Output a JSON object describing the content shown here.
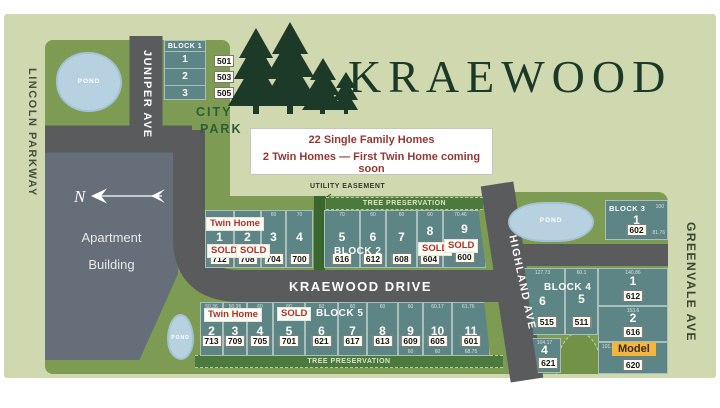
{
  "title": "KRAEWOOD",
  "info_box": {
    "line1": "22 Single Family Homes",
    "line2": "2 Twin Homes — First Twin Home coming soon"
  },
  "streets": {
    "lincoln_parkway": "LINCOLN PARKWAY",
    "juniper_ave": "JUNIPER AVE",
    "kraewood_drive": "KRAEWOOD DRIVE",
    "highland_ave": "HIGHLAND AVE",
    "greenvale_ave": "GREENVALE AVE"
  },
  "areas": {
    "city_park_line1": "CITY",
    "city_park_line2": "PARK",
    "apartment_line1": "Apartment",
    "apartment_line2": "Building",
    "pond_label": "POND",
    "tree_preservation": "TREE PRESERVATION",
    "utility_easement": "UTILITY EASEMENT",
    "north_label": "N"
  },
  "signs": {
    "twin_home": "Twin Home",
    "sold": "SOLD",
    "model": "Model"
  },
  "blocks": {
    "block1": {
      "label": "BLOCK 1",
      "lots": [
        {
          "num": "1",
          "addr": "501"
        },
        {
          "num": "2",
          "addr": "503"
        },
        {
          "num": "3",
          "addr": "505"
        }
      ]
    },
    "block2": {
      "label": "BLOCK 2",
      "lots": [
        {
          "num": "1",
          "addr": "712",
          "dim": "",
          "sold": true,
          "twin": true
        },
        {
          "num": "2",
          "addr": "708",
          "dim": "",
          "sold": true,
          "twin": true
        },
        {
          "num": "3",
          "addr": "704",
          "dim": "60"
        },
        {
          "num": "4",
          "addr": "700",
          "dim": "70"
        },
        {
          "num": "5",
          "addr": "616",
          "dim": "70"
        },
        {
          "num": "6",
          "addr": "612",
          "dim": "60"
        },
        {
          "num": "7",
          "addr": "608",
          "dim": "60"
        },
        {
          "num": "8",
          "addr": "604",
          "dim": "60",
          "sold": true
        },
        {
          "num": "9",
          "addr": "600",
          "dim": "70.46",
          "sold": true
        }
      ]
    },
    "block3": {
      "label": "BLOCK 3",
      "lots": [
        {
          "num": "1",
          "addr": "602",
          "dim": "100",
          "dim2": "81.76"
        }
      ]
    },
    "block4": {
      "label": "BLOCK 4",
      "lots": [
        {
          "num": "1",
          "addr": "612",
          "dim": "140.86"
        },
        {
          "num": "2",
          "addr": "616",
          "dim": "153.6"
        },
        {
          "num": "",
          "addr": "620",
          "dim": "101.15",
          "model": true
        },
        {
          "num": "4",
          "addr": "621",
          "dim": "104.17"
        },
        {
          "num": "5",
          "addr": "511",
          "dim": "60.1"
        },
        {
          "num": "6",
          "addr": "515",
          "dim": "127.73"
        }
      ]
    },
    "block5": {
      "label": "BLOCK 5",
      "lots": [
        {
          "num": "2",
          "addr": "713",
          "dim": "50.36",
          "twin": true
        },
        {
          "num": "3",
          "addr": "709",
          "dim": "50.36",
          "twin": true
        },
        {
          "num": "4",
          "addr": "705",
          "dim": "60"
        },
        {
          "num": "5",
          "addr": "701",
          "dim": "60",
          "sold": true
        },
        {
          "num": "6",
          "addr": "621",
          "dim": "60"
        },
        {
          "num": "7",
          "addr": "617",
          "dim": "60"
        },
        {
          "num": "8",
          "addr": "613",
          "dim": "60"
        },
        {
          "num": "9",
          "addr": "609",
          "dim": "60",
          "dim2": "60"
        },
        {
          "num": "10",
          "addr": "605",
          "dim": "60.17",
          "dim2": "60"
        },
        {
          "num": "11",
          "addr": "601",
          "dim": "61.76",
          "dim2": "68.75"
        }
      ]
    }
  },
  "colors": {
    "background": "#cfd8af",
    "grass": "#7d9b52",
    "lot_fill": "#5e8586",
    "road": "#5a5b5d",
    "pond": "#b7d1e0",
    "apartment": "#656e79",
    "tree_band": "#4c7a3e",
    "title_green": "#1c3827",
    "accent_red": "#b13226",
    "info_red": "#943634",
    "model_yellow": "#f2b53f"
  }
}
